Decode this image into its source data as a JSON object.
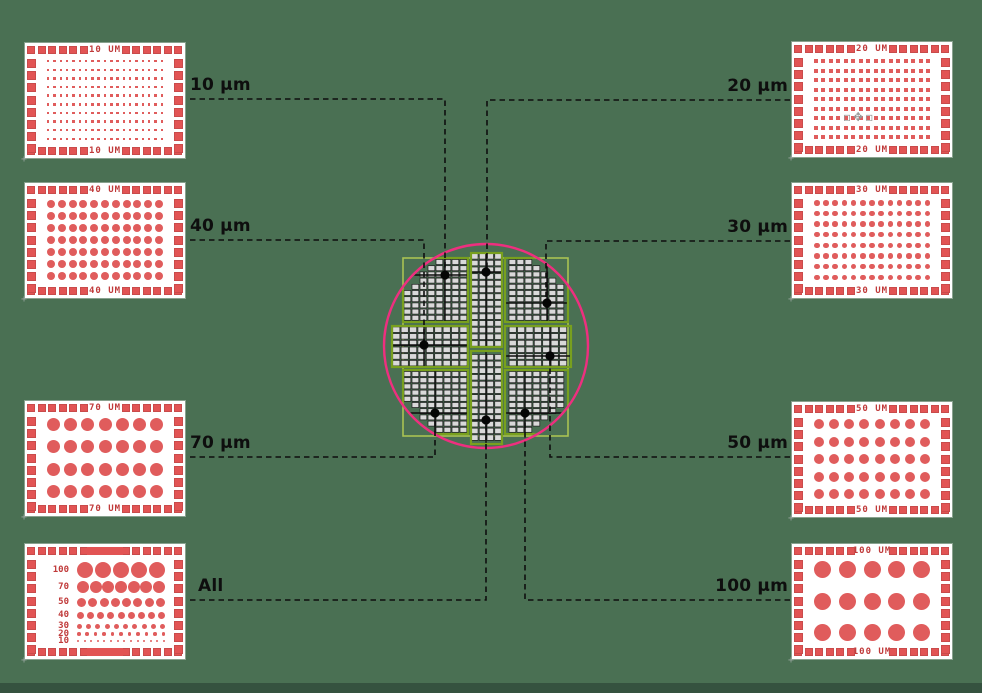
{
  "background": {
    "page_color": "#4a7053",
    "footer_color": "#35523f"
  },
  "palette": {
    "red": "#e05c5c",
    "red_dark": "#c03a3a",
    "panel_bg": "#ffffff",
    "pink_circle": "#ee2f7f",
    "green_outer": "#a9c253",
    "green_sector": "#78a01e",
    "cell_fill": "#d9d9d9",
    "cell_line": "#1c1c1c",
    "line_black": "#0e0e0e",
    "dot_black": "#050505"
  },
  "cursor_artifact": {
    "icon": "move-cursor",
    "glyph": "▫✥▫"
  },
  "panels": [
    {
      "id": "10um",
      "label": "10 UM",
      "x": 25,
      "y": 43,
      "shape": "square",
      "cols": 19,
      "rows": 10,
      "dot": 2.4
    },
    {
      "id": "40um",
      "label": "40 UM",
      "x": 25,
      "y": 183,
      "shape": "circle",
      "cols": 11,
      "rows": 7,
      "dot": 8
    },
    {
      "id": "70um",
      "label": "70 UM",
      "x": 25,
      "y": 401,
      "shape": "circle",
      "cols": 7,
      "rows": 4,
      "dot": 13
    },
    {
      "id": "all",
      "label": "",
      "x": 25,
      "y": 544,
      "type": "all",
      "rows_spec": [
        {
          "label": "100",
          "count": 5,
          "size": 16
        },
        {
          "label": "70",
          "count": 7,
          "size": 12
        },
        {
          "label": "50",
          "count": 8,
          "size": 9
        },
        {
          "label": "40",
          "count": 9,
          "size": 7
        },
        {
          "label": "30",
          "count": 10,
          "size": 5
        },
        {
          "label": "20",
          "count": 11,
          "size": 3.5
        },
        {
          "label": "10",
          "count": 14,
          "size": 2
        }
      ]
    },
    {
      "id": "20um",
      "label": "20 UM",
      "x": 792,
      "y": 42,
      "shape": "square",
      "cols": 16,
      "rows": 9,
      "dot": 4
    },
    {
      "id": "30um",
      "label": "30 UM",
      "x": 792,
      "y": 183,
      "shape": "circle",
      "cols": 13,
      "rows": 8,
      "dot": 5.5
    },
    {
      "id": "50um",
      "label": "50 UM",
      "x": 792,
      "y": 402,
      "shape": "circle",
      "cols": 8,
      "rows": 5,
      "dot": 10
    },
    {
      "id": "100um",
      "label": "100 UM",
      "x": 792,
      "y": 544,
      "shape": "circle",
      "cols": 5,
      "rows": 3,
      "dot": 17
    }
  ],
  "callouts": [
    {
      "label": "10 µm",
      "side": "left",
      "line_y": 99,
      "x_from": 190,
      "x_to": 445,
      "dot": [
        445,
        275
      ]
    },
    {
      "label": "40 µm",
      "side": "left",
      "line_y": 240,
      "x_from": 190,
      "x_to": 424,
      "dot": [
        424,
        345
      ]
    },
    {
      "label": "70 µm",
      "side": "left",
      "line_y": 457,
      "x_from": 190,
      "x_to": 435,
      "dot": [
        435,
        413
      ]
    },
    {
      "label": "All",
      "side": "left",
      "line_y": 600,
      "x_from": 190,
      "x_to": 486,
      "dot": [
        486,
        420
      ]
    },
    {
      "label": "20 µm",
      "side": "right",
      "line_y": 100,
      "x_from": 790,
      "x_to": 487,
      "dot": [
        486,
        272
      ]
    },
    {
      "label": "30 µm",
      "side": "right",
      "line_y": 241,
      "x_from": 790,
      "x_to": 546,
      "dot": [
        547,
        303
      ]
    },
    {
      "label": "50 µm",
      "side": "right",
      "line_y": 457,
      "x_from": 790,
      "x_to": 550,
      "dot": [
        550,
        356
      ]
    },
    {
      "label": "100 µm",
      "side": "right",
      "line_y": 600,
      "x_from": 790,
      "x_to": 525,
      "dot": [
        525,
        413
      ]
    }
  ],
  "wafer": {
    "circle": {
      "cx": 486,
      "cy": 346,
      "r": 102
    },
    "outer_rect": {
      "x": 403,
      "y": 258,
      "w": 165,
      "h": 178
    },
    "sectors": [
      {
        "name": "top-left",
        "x": 403,
        "y": 258,
        "w": 65,
        "h": 64,
        "clip": true,
        "cw": 8.0,
        "ch": 6.2,
        "dot": [
          445,
          275
        ]
      },
      {
        "name": "top-center",
        "x": 471,
        "y": 253,
        "w": 31,
        "h": 94,
        "clip": false,
        "cw": 7.75,
        "ch": 6.7,
        "dot": [
          486,
          272
        ]
      },
      {
        "name": "top-right",
        "x": 505,
        "y": 258,
        "w": 63,
        "h": 64,
        "clip": true,
        "cw": 8.0,
        "ch": 6.2,
        "dot": [
          547,
          303
        ]
      },
      {
        "name": "mid-left",
        "x": 392,
        "y": 326,
        "w": 76,
        "h": 41,
        "clip": false,
        "cw": 8.4,
        "ch": 6.7,
        "dot": [
          424,
          345
        ]
      },
      {
        "name": "mid-right",
        "x": 505,
        "y": 326,
        "w": 66,
        "h": 41,
        "clip": false,
        "cw": 8.4,
        "ch": 6.7,
        "dot": [
          550,
          356
        ]
      },
      {
        "name": "bottom-left",
        "x": 403,
        "y": 370,
        "w": 65,
        "h": 64,
        "clip": true,
        "cw": 8.0,
        "ch": 6.2,
        "dot": [
          435,
          413
        ]
      },
      {
        "name": "bottom-center",
        "x": 471,
        "y": 351,
        "w": 31,
        "h": 93,
        "clip": false,
        "cw": 7.75,
        "ch": 6.7,
        "dot": [
          486,
          420
        ]
      },
      {
        "name": "bottom-right",
        "x": 505,
        "y": 370,
        "w": 63,
        "h": 64,
        "clip": true,
        "cw": 8.0,
        "ch": 6.2,
        "dot": [
          525,
          413
        ]
      }
    ]
  }
}
